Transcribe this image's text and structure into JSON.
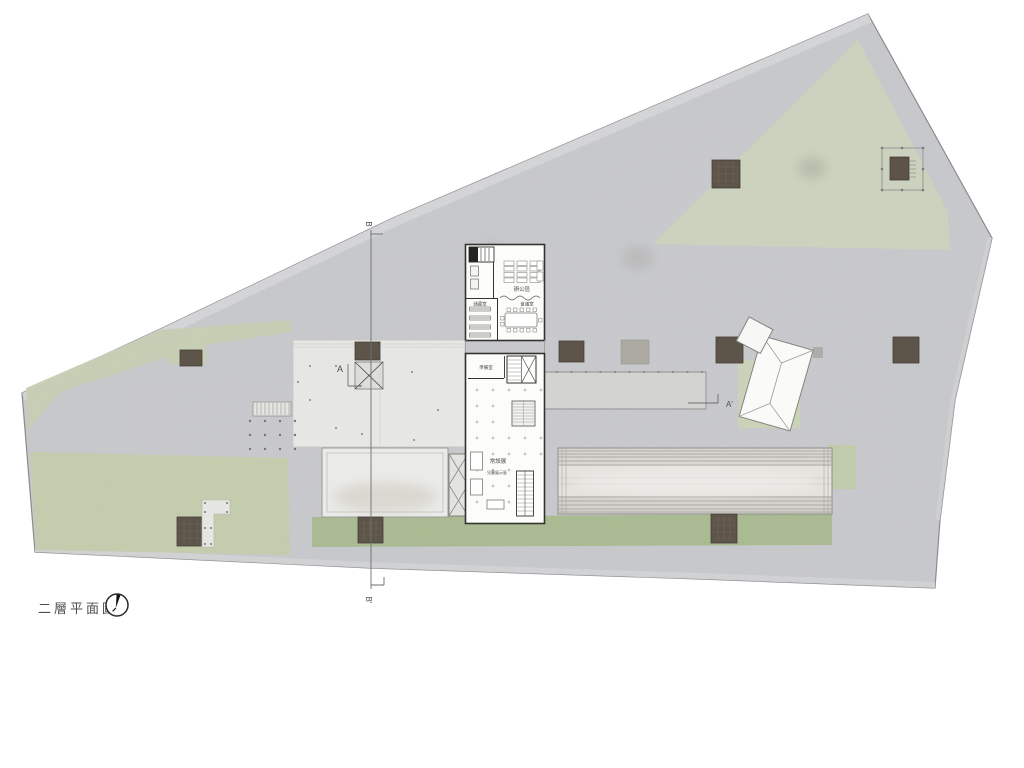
{
  "drawing": {
    "title": "二層平面圖"
  },
  "north_indicator": {
    "icon": "north-arrow-icon"
  },
  "section_markers": {
    "b_top": "B",
    "b_bottom": "B'",
    "a_left": "A",
    "a_right": "A'"
  },
  "rooms": {
    "office": "辦公區",
    "meeting": "會議室",
    "archive": "儲藏室",
    "prep": "準備室",
    "permanent_exhibition": "常設展",
    "children_exhibition": "兒童展示區"
  },
  "colors": {
    "paving": "#cacbce",
    "lawn": "#ced5bf",
    "lawn_dark": "#a9bc90",
    "planter": "#5e554a",
    "building": "#fcfcfa",
    "terrace": "#ebebe8",
    "outline": "#35332f"
  }
}
